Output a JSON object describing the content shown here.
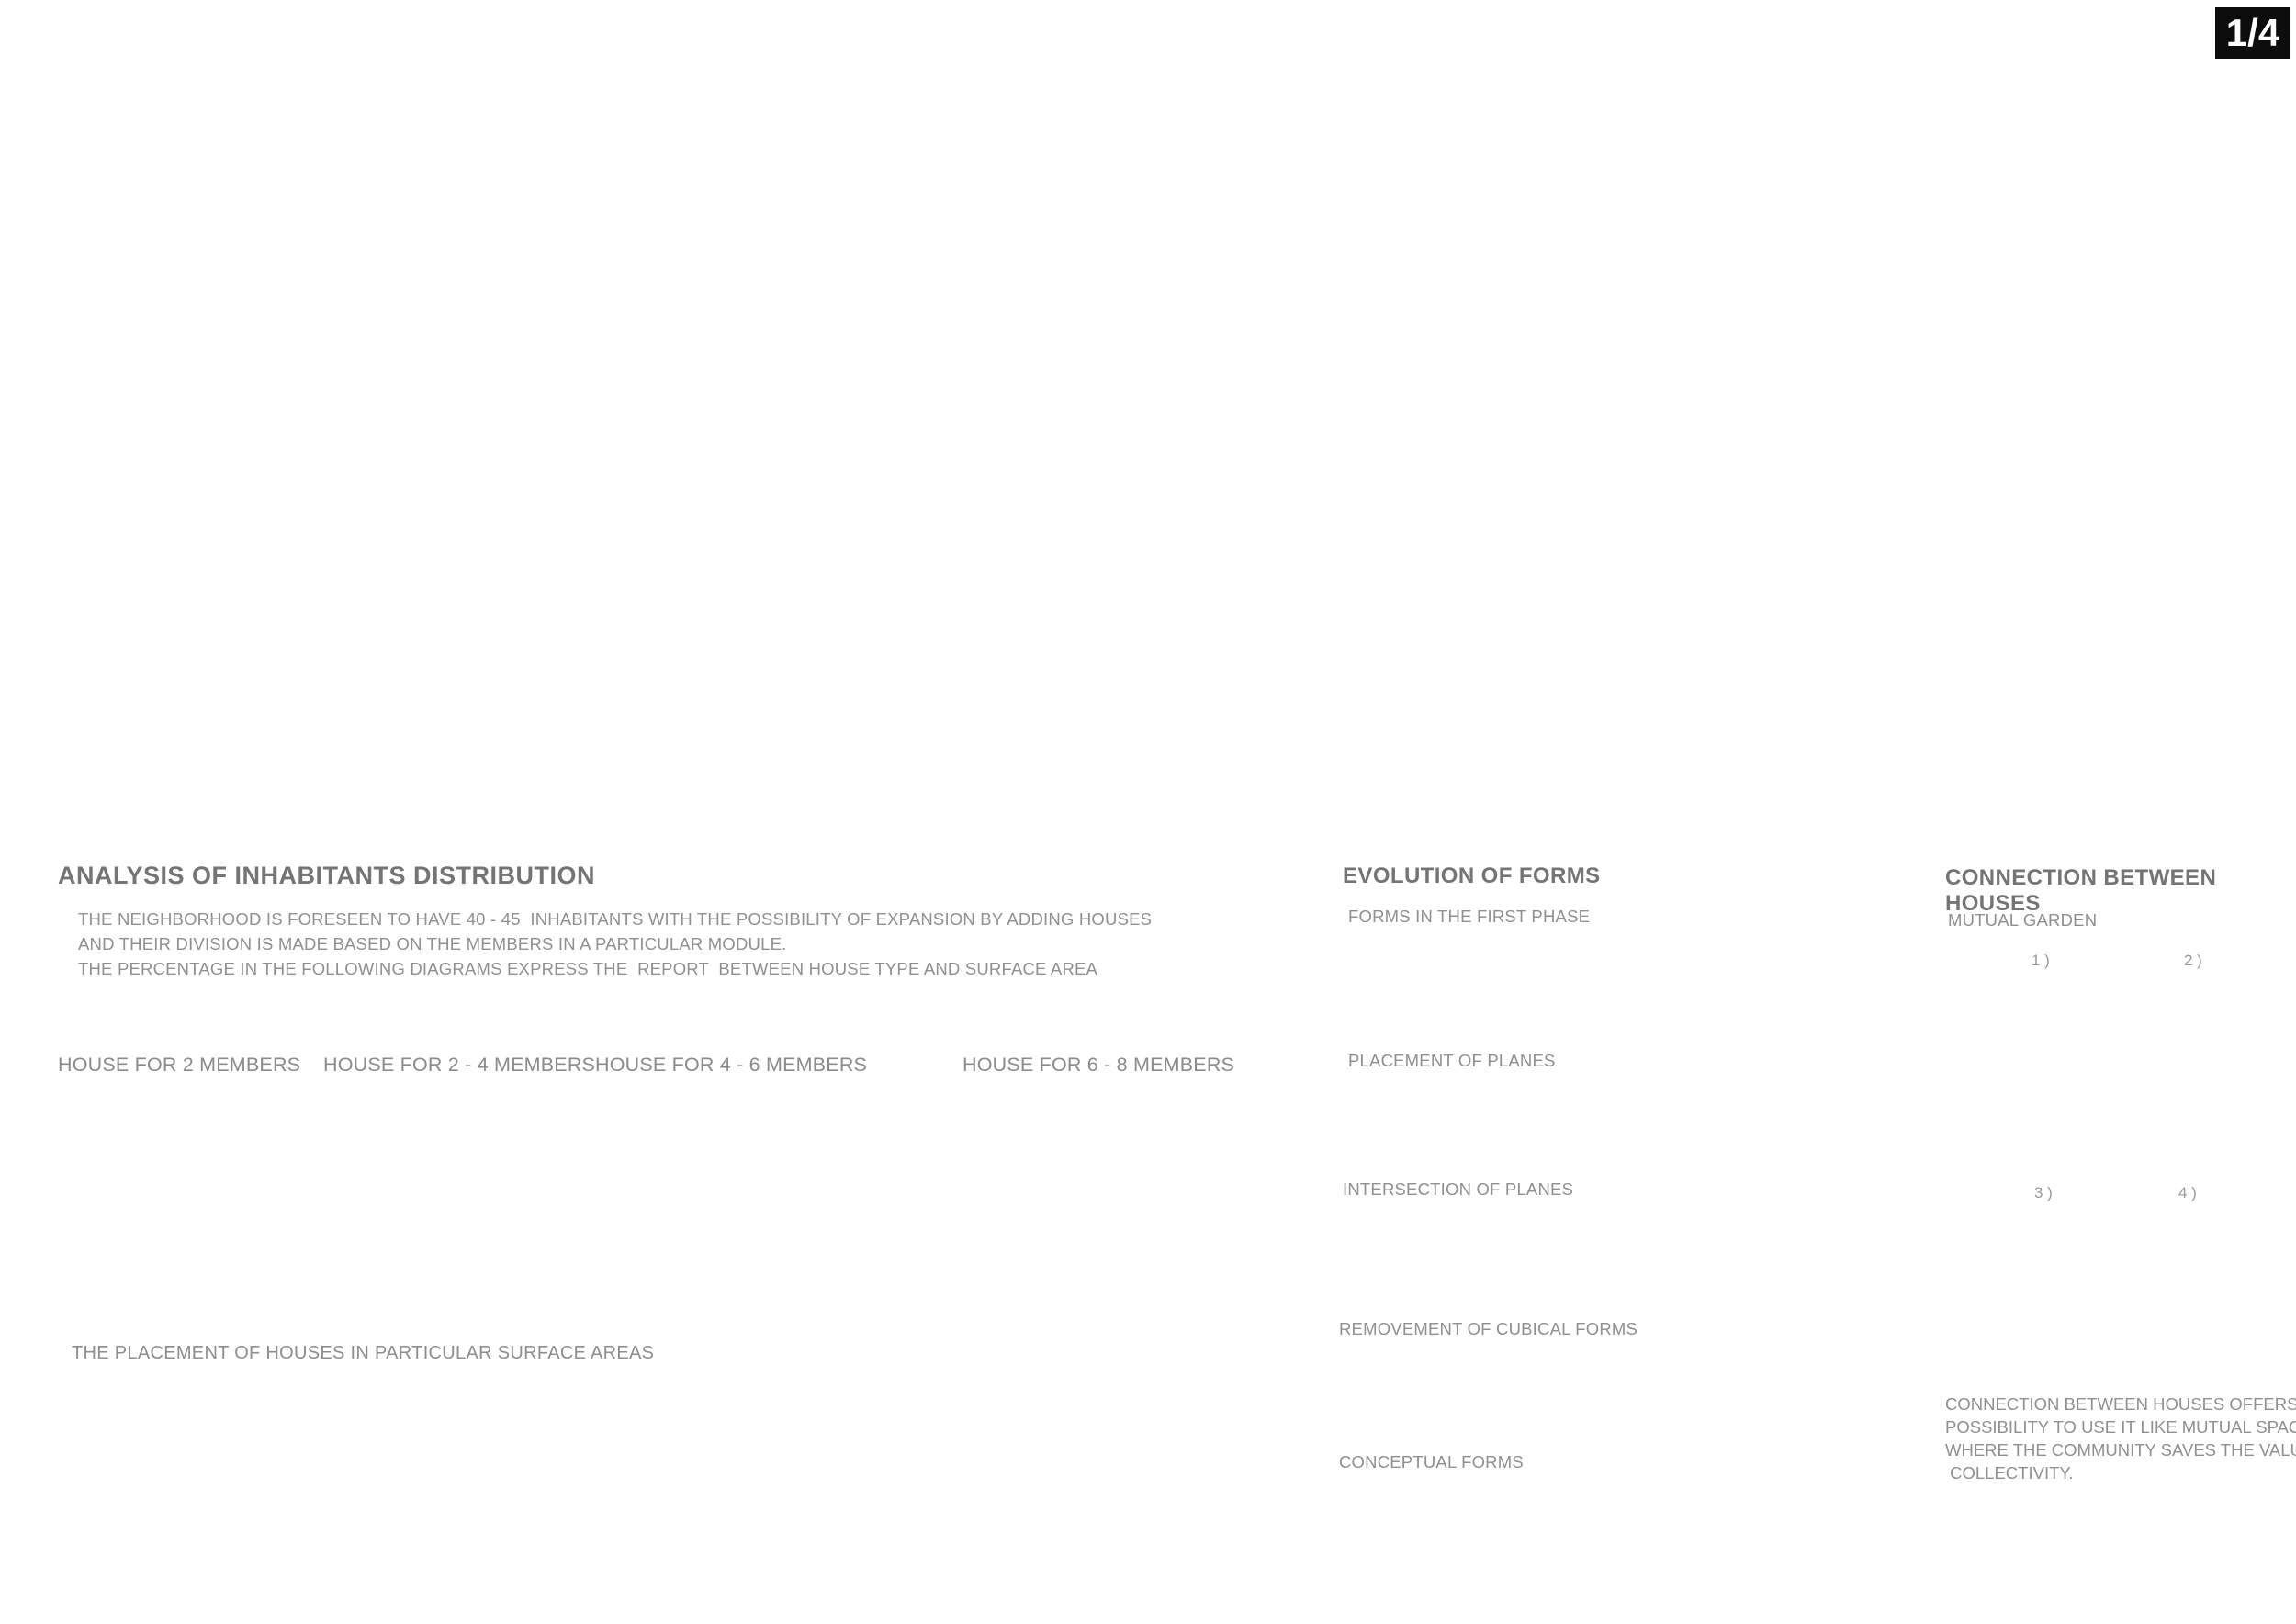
{
  "page": {
    "badge": "1/4"
  },
  "palette": {
    "accent_red": "#cc3a2e",
    "wood_tan": "#c8ab7e",
    "figure_purple": "#8d188d",
    "pie_grey": "#cccccc",
    "text_grey": "#8a8a8a"
  },
  "analysis": {
    "title": "ANALYSIS OF INHABITANTS DISTRIBUTION",
    "intro_lines": [
      "THE NEIGHBORHOOD IS FORESEEN TO HAVE 40 - 45  INHABITANTS WITH THE POSSIBILITY OF EXPANSION BY ADDING HOUSES",
      "AND THEIR DIVISION IS MADE BASED ON THE MEMBERS IN A PARTICULAR MODULE.",
      "THE PERCENTAGE IN THE FOLLOWING DIAGRAMS EXPRESS THE  REPORT  BETWEEN HOUSE TYPE AND SURFACE AREA"
    ],
    "placement_title": "THE PLACEMENT OF HOUSES IN PARTICULAR SURFACE AREAS"
  },
  "chart_data": [
    {
      "type": "pie",
      "title": "HOUSE FOR 2 MEMBERS",
      "labels": [
        "HOUSE FOR 2 MEMBERS",
        "OTHER HOUSES"
      ],
      "values": [
        14,
        86
      ],
      "slice_label": "14 %",
      "slice_color": "#d6da85",
      "rest_color": "#cccccc",
      "members_icon": "two-adults-icon"
    },
    {
      "type": "pie",
      "title": "HOUSE FOR 2 - 4 MEMBERS",
      "labels": [
        "HOUSE FOR 2 - 4 MEMBERS",
        "OTHER HOUSES"
      ],
      "values": [
        20,
        80
      ],
      "slice_label": "20 %",
      "slice_color": "#f9c38f",
      "rest_color": "#cccccc",
      "members_icon": "three-adults-icon"
    },
    {
      "type": "pie",
      "title": "HOUSE FOR 4 - 6 MEMBERS",
      "labels": [
        "HOUSE FOR 4 - 6 MEMBERS",
        "OTHER HOUSES"
      ],
      "values": [
        27,
        73
      ],
      "slice_label": "27 %",
      "slice_color": "#c9979b",
      "rest_color": "#cccccc",
      "members_icon": "group-of-six-icon"
    },
    {
      "type": "pie",
      "title": "HOUSE FOR 6 - 8 MEMBERS",
      "labels": [
        "HOUSE FOR 6 - 8 MEMBERS",
        "OTHER HOUSES"
      ],
      "values": [
        39,
        61
      ],
      "slice_label": "39 %",
      "slice_color": "#d0e6f8",
      "rest_color": "#cccccc",
      "members_icon": "family-with-children-icon"
    }
  ],
  "evolution": {
    "title": "EVOLUTION OF  FORMS",
    "stages": [
      "FORMS IN THE FIRST PHASE",
      "PLACEMENT OF PLANES",
      "INTERSECTION OF PLANES",
      "REMOVEMENT OF CUBICAL FORMS",
      "CONCEPTUAL FORMS"
    ]
  },
  "connection": {
    "title": "CONNECTION BETWEEN HOUSES",
    "subtitle": "MUTUAL GARDEN",
    "figure_labels": [
      "1 )",
      "2 )",
      "3 )",
      "4 )"
    ],
    "body_lines": [
      "CONNECTION BETWEEN HOUSES OFFERS THE",
      "POSSIBILITY TO USE IT LIKE MUTUAL SPACE",
      "WHERE THE COMMUNITY SAVES THE VALUE OF",
      " COLLECTIVITY."
    ],
    "node_labels": [
      "A",
      "B",
      "C",
      "D"
    ]
  }
}
